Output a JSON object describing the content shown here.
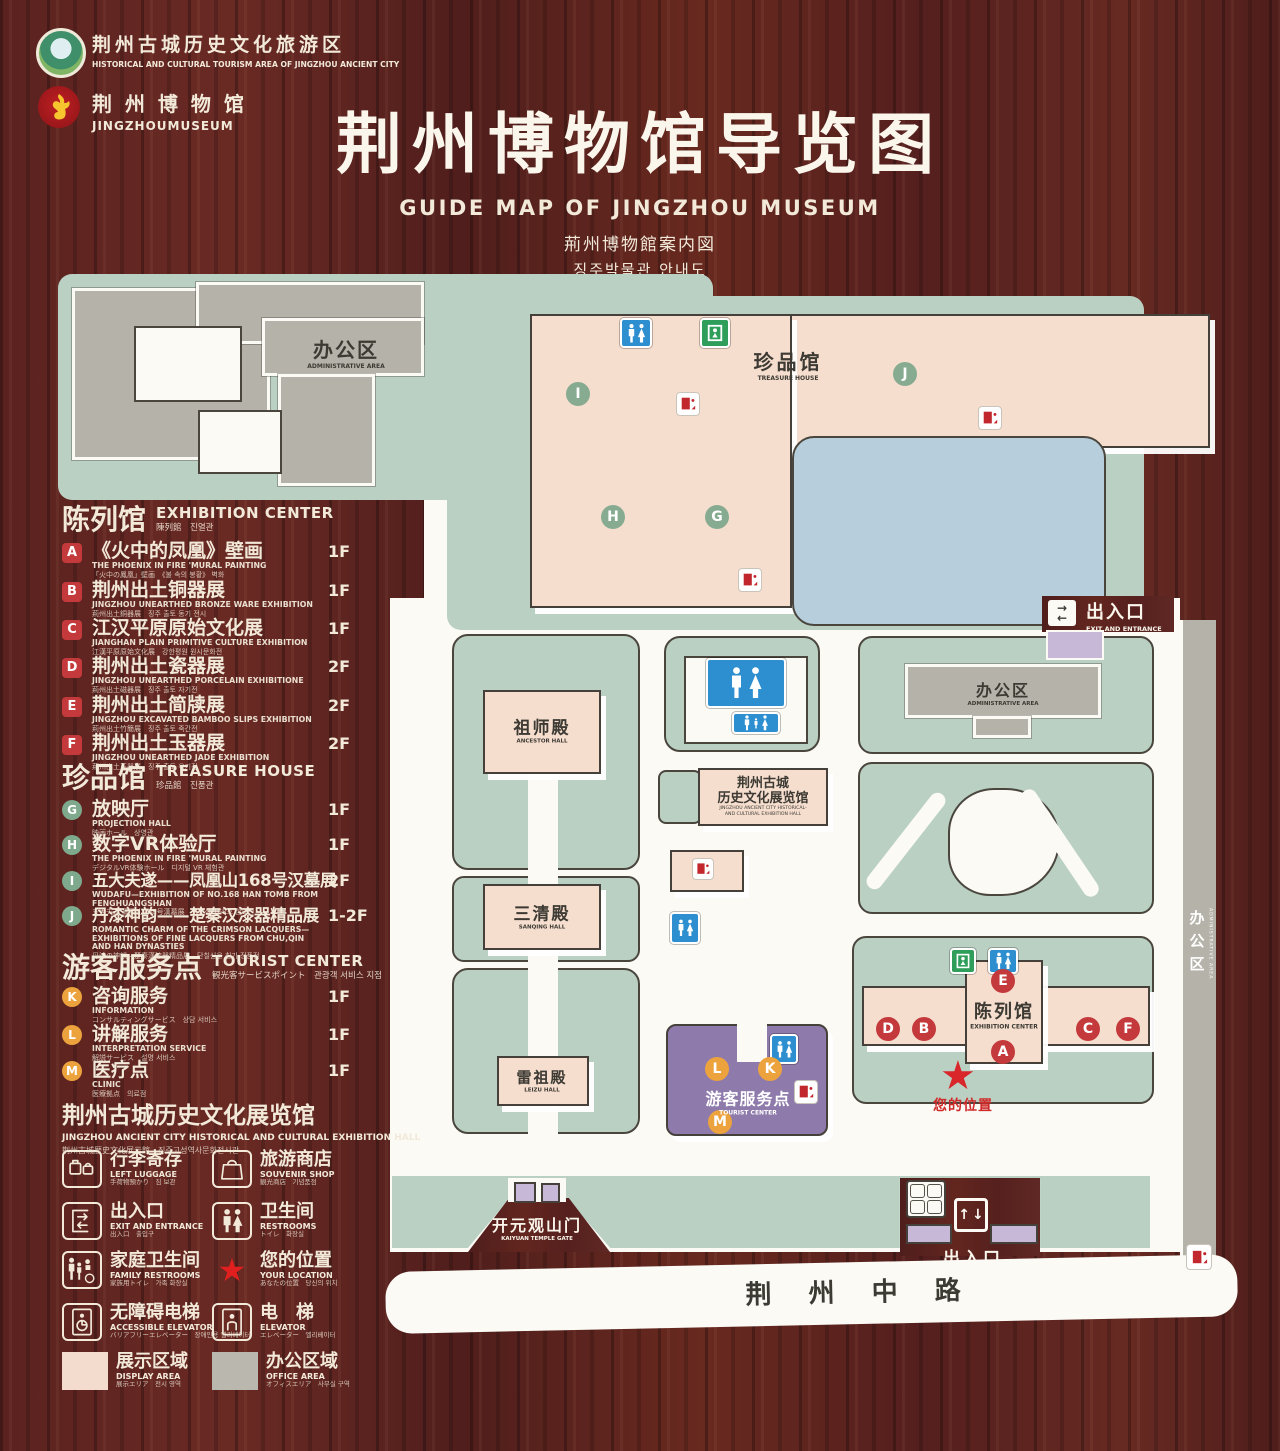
{
  "header": {
    "tourism_logo": {
      "zh": "荆州古城历史文化旅游区",
      "en": "HISTORICAL AND CULTURAL TOURISM AREA OF JINGZHOU ANCIENT CITY"
    },
    "museum_logo": {
      "zh": "荆 州 博 物 馆",
      "en": "JINGZHOUMUSEUM"
    },
    "title": {
      "zh": "荆州博物馆导览图",
      "en": "GUIDE MAP OF JINGZHOU MUSEUM",
      "ja": "荊州博物館案内図",
      "ko": "징주박물관 안내도"
    }
  },
  "legend": {
    "exhibition": {
      "title": {
        "zh": "陈列馆",
        "en": "EXHIBITION CENTER",
        "sub": "陳列館　진열관"
      },
      "items": [
        {
          "k": "A",
          "zh": "《火中的凤凰》壁画",
          "en": "THE PHOENIX IN FIRE 'MURAL PAINTING",
          "sub": "「火中の鳳凰」壁画　《불 속의 봉황》 벽화",
          "floor": "1F"
        },
        {
          "k": "B",
          "zh": "荆州出土铜器展",
          "en": "JINGZHOU UNEARTHED BRONZE WARE EXHIBITION",
          "sub": "荊州出土銅器展　징주 출토 동기 전시",
          "floor": "1F"
        },
        {
          "k": "C",
          "zh": "江汉平原原始文化展",
          "en": "JIANGHAN PLAIN PRIMITIVE CULTURE EXHIBITION",
          "sub": "江漢平原原始文化展　강한평원 원시문화전",
          "floor": "1F"
        },
        {
          "k": "D",
          "zh": "荆州出土瓷器展",
          "en": "JINGZHOU UNEARTHED PORCELAIN EXHIBITIONE",
          "sub": "荊州出土磁器展　징주 출토 자기전",
          "floor": "2F"
        },
        {
          "k": "E",
          "zh": "荆州出土简牍展",
          "en": "JINGZHOU EXCAVATED BAMBOO SLIPS EXHIBITION",
          "sub": "荊州出土竹簡展　징주 출토 죽간전",
          "floor": "2F"
        },
        {
          "k": "F",
          "zh": "荆州出土玉器展",
          "en": "JINGZHOU UNEARTHED JADE EXHIBITION",
          "sub": "荊州出土玉器展　징주 출토 옥기전",
          "floor": "2F"
        }
      ]
    },
    "treasure": {
      "title": {
        "zh": "珍品馆",
        "en": "TREASURE HOUSE",
        "sub": "珍品館　진품관"
      },
      "items": [
        {
          "k": "G",
          "zh": "放映厅",
          "en": "PROJECTION HALL",
          "sub": "映画ホール　상영관",
          "floor": "1F"
        },
        {
          "k": "H",
          "zh": "数字VR体验厅",
          "en": "THE PHOENIX IN FIRE 'MURAL PAINTING",
          "sub": "デジタルVR体験ホール　디지털 VR 체험관",
          "floor": "1F"
        },
        {
          "k": "I",
          "zh": "五大夫遂——凤凰山168号汉墓展",
          "en": "WUDAFU—EXHIBITION OF NO.168 HAN TOMB FROM FENGHUANGSHAN",
          "sub": "五大夫遂 鳳凰山168号漢墓展　봉황산 168호 한묘전",
          "floor": "2F"
        },
        {
          "k": "J",
          "zh": "丹漆神韵——楚秦汉漆器精品展",
          "en": "ROMANTIC CHARM OF THE CRIMSON LACQUERS— EXHIBITIONS OF FINE LACQUERS FROM CHU,QIN AND HAN DYNASTIES",
          "sub": "丹漆の神韻—楚秦漢漆器精品展　단칠신운 칠기 정품전",
          "floor": "1-2F"
        }
      ]
    },
    "tourist": {
      "title": {
        "zh": "游客服务点",
        "en": "TOURIST CENTER",
        "sub": "観光客サービスポイント　관광객 서비스 지점"
      },
      "items": [
        {
          "k": "K",
          "zh": "咨询服务",
          "en": "INFORMATION",
          "sub": "コンサルティングサービス　상담 서비스",
          "floor": "1F"
        },
        {
          "k": "L",
          "zh": "讲解服务",
          "en": "INTERPRETATION SERVICE",
          "sub": "解説サービス　설명 서비스",
          "floor": "1F"
        },
        {
          "k": "M",
          "zh": "医疗点",
          "en": "CLINIC",
          "sub": "医療拠点　의료점",
          "floor": "1F"
        }
      ]
    },
    "hall_note": {
      "zh": "荆州古城历史文化展览馆",
      "en": "JINGZHOU ANCIENT CITY HISTORICAL AND CULTURAL EXHIBITION HALL",
      "sub": "荆州古城歴史文化展示館　징주고성역사문화전시관"
    },
    "facilities": [
      {
        "icon": "left-luggage-icon",
        "zh": "行李寄存",
        "en": "LEFT LUGGAGE",
        "sub": "手荷物預かり　짐 보관"
      },
      {
        "icon": "souvenir-shop-icon",
        "zh": "旅游商店",
        "en": "SOUVENIR SHOP",
        "sub": "観光商店　기념품점"
      },
      {
        "icon": "exit-entrance-icon",
        "zh": "出入口",
        "en": "EXIT AND ENTRANCE",
        "sub": "出入口　출입구"
      },
      {
        "icon": "restrooms-icon",
        "zh": "卫生间",
        "en": "RESTROOMS",
        "sub": "トイレ　화장실"
      },
      {
        "icon": "family-restrooms-icon",
        "zh": "家庭卫生间",
        "en": "FAMILY RESTROOMS",
        "sub": "家族用トイレ　가족 화장실"
      },
      {
        "icon": "your-location-icon",
        "zh": "您的位置",
        "en": "YOUR LOCATION",
        "sub": "あなたの位置　당신의 위치"
      },
      {
        "icon": "accessible-elevator-icon",
        "zh": "无障碍电梯",
        "en": "ACCESSIBLE ELEVATOR",
        "sub": "バリアフリーエレベーター　장애인용 엘리베이터"
      },
      {
        "icon": "elevator-icon",
        "zh": "电　梯",
        "en": "ELEVATOR",
        "sub": "エレベーター　엘리베이터"
      }
    ],
    "areas": [
      {
        "zh": "展示区域",
        "en": "DISPLAY AREA",
        "sub": "展示エリア　전시 영역",
        "color": "#f3dbcd"
      },
      {
        "zh": "办公区域",
        "en": "OFFICE AREA",
        "sub": "オフィスエリア　사무실 구역",
        "color": "#b9b7ae"
      }
    ]
  },
  "map": {
    "admin_nw": {
      "zh": "办公区",
      "en": "ADMINISTRATIVE AREA"
    },
    "treasure": {
      "zh": "珍品馆",
      "en": "TREASURE HOUSE"
    },
    "ancestor": {
      "zh": "祖师殿",
      "en": "ANCESTOR HALL"
    },
    "sanqing": {
      "zh": "三清殿",
      "en": "SANQING HALL"
    },
    "leizu": {
      "zh": "雷祖殿",
      "en": "LEIZU HALL"
    },
    "exhibition_hall": {
      "l1": "荆州古城",
      "l2": "历史文化展览馆",
      "l3": "JINGZHOU ANCIENT CITY HISTORICAL-",
      "l4": "AND CULTURAL EXHIBITION HALL"
    },
    "admin_e": {
      "zh": "办公区",
      "en": "ADMINISTRATIVE AREA"
    },
    "admin_strip": {
      "zh": "办公区",
      "en": "ADMINISTRATIVE AREA"
    },
    "exhibition_center": {
      "zh": "陈列馆",
      "en": "EXHIBITION CENTER"
    },
    "tourist_center": {
      "zh": "游客服务点",
      "en": "TOURIST CENTER"
    },
    "your_location": "您的位置",
    "location_star": "★",
    "gate": {
      "zh": "开元观山门",
      "en": "KAIYUAN TEMPLE GATE"
    },
    "exit_ne": {
      "zh": "出入口",
      "en": "EXIT AND ENTRANCE"
    },
    "exit_s": {
      "zh": "出入口",
      "en": "EXIT AND ENTRANCE"
    },
    "road": "荆 州 中 路",
    "chips": {
      "i": "I",
      "h": "H",
      "g": "G",
      "j": "J",
      "e": "E",
      "d": "D",
      "b": "B",
      "a": "A",
      "c": "C",
      "f": "F",
      "k": "K",
      "l": "L",
      "m": "M"
    },
    "icons": {
      "restroom-icon": "man-woman-figures",
      "family-restroom-icon": "family-figures",
      "emergency-exit-icon": "figure-in-doorway",
      "elevator-icon": "red-elevator-cab",
      "entrance-arrows-icon": "double-arrows",
      "ticket-booth-icon": "four-cells",
      "your-location-icon": "red-star"
    }
  },
  "colors": {
    "accent_red": "#c4393b",
    "chip_green": "#87ab91",
    "chip_orange": "#eda33d",
    "sage": "#bad0c3",
    "building_pink": "#f6decf",
    "office_gray": "#b5b2a9",
    "lake_blue": "#b7cfdc",
    "tourist_purple": "#8f7bab",
    "entrance_purple": "#c6b8d6",
    "restroom_blue": "#2e8fd0",
    "exit_green": "#2f9e5b",
    "star_red": "#d8262b",
    "wood": "#5a221f"
  }
}
